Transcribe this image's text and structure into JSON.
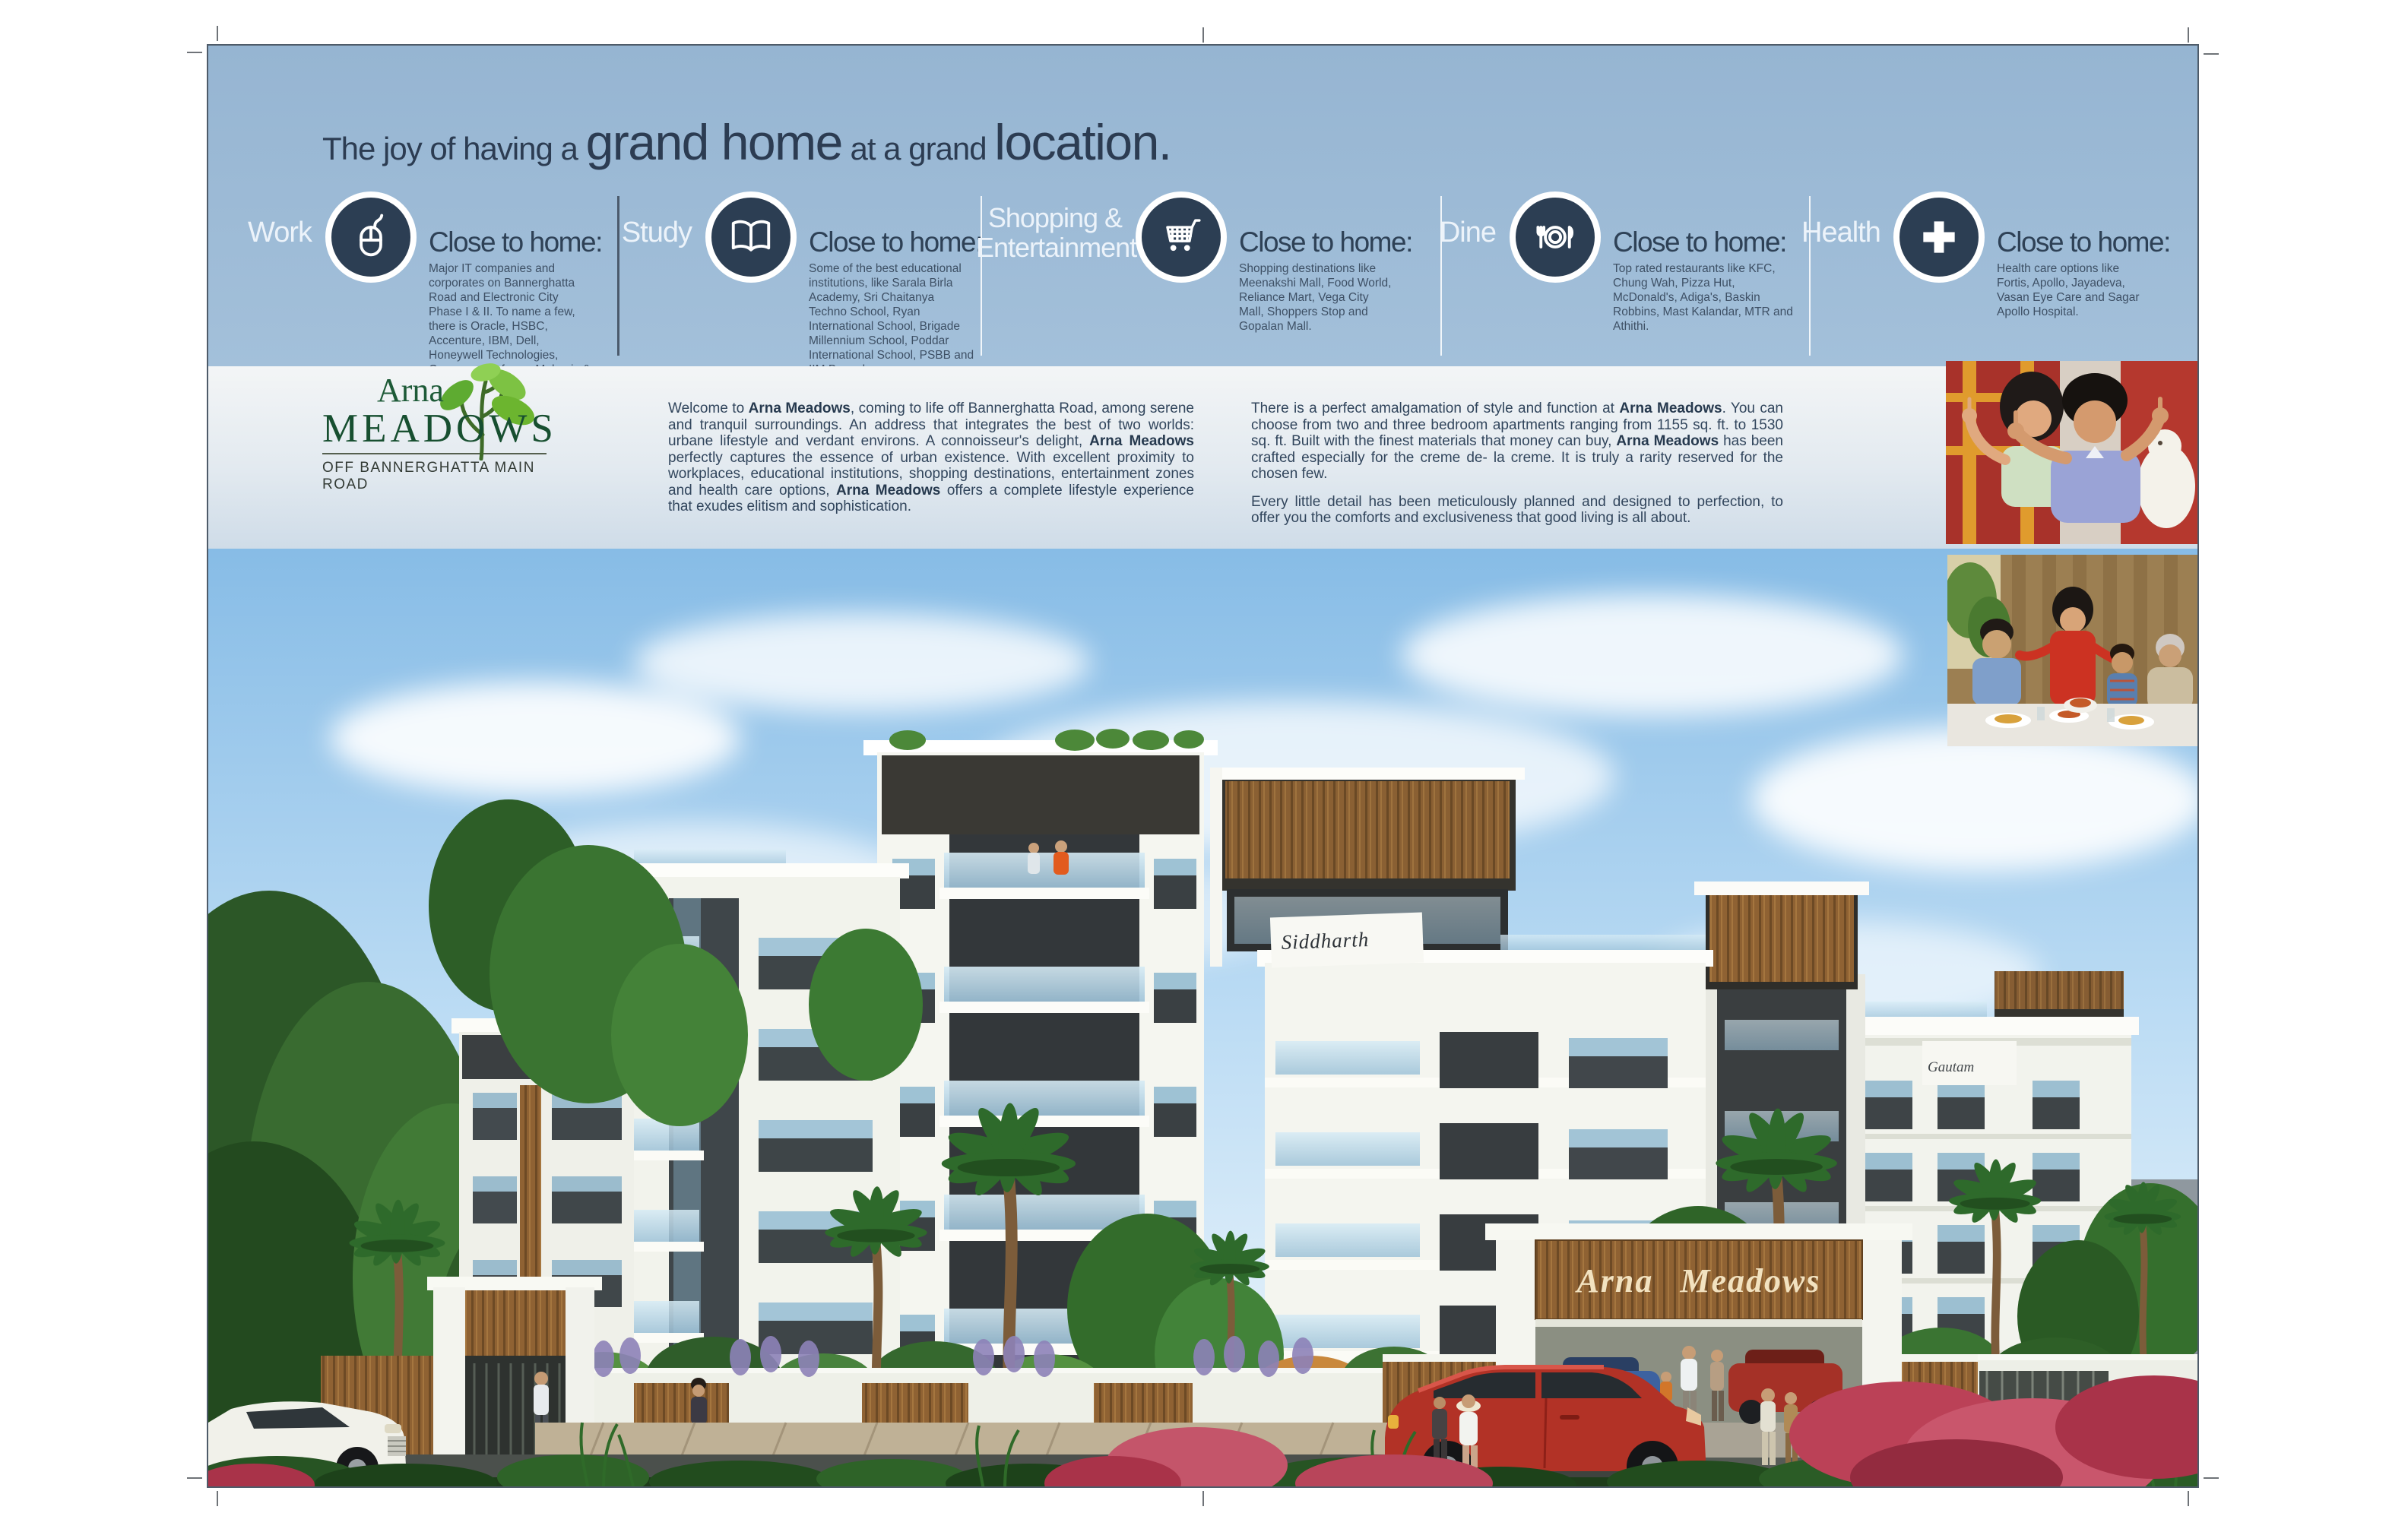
{
  "brand_colors": {
    "header_blue": "#9cbad5",
    "icon_navy": "#2c3e53",
    "headline_navy": "#2c3c52",
    "body_text": "#33465c",
    "logo_green": "#1d5a37",
    "leaf_green": "#6cb52f",
    "wood_brown": "#8f6233",
    "sky_blue": "#87bce6",
    "red_car": "#b23226"
  },
  "header": {
    "headline": {
      "part1": "The joy of having a ",
      "part2": "grand home",
      "part3": " at a grand ",
      "part4": "location."
    },
    "columns": [
      {
        "label": "Work",
        "icon": "computer-mouse-icon",
        "heading": "Close to home:",
        "body": "Major IT companies and corporates on Bannerghatta Road and Electronic City Phase I & II. To name a few, there is Oracle, HSBC, Accenture, IBM, Dell, Honeywell Technologies, Convergys, Infosys, Mphasis & Adobe Systems."
      },
      {
        "label": "Study",
        "icon": "open-book-icon",
        "heading": "Close to home:",
        "body": "Some of the best educational institutions, like Sarala Birla Academy, Sri Chaitanya Techno School, Ryan International School, Brigade Millennium School, Poddar International School, PSBB and IIM Bangalore."
      },
      {
        "label": "Shopping & Entertainment",
        "icon": "shopping-cart-icon",
        "heading": "Close to home:",
        "body": "Shopping destinations like Meenakshi Mall, Food World, Reliance Mart, Vega City Mall, Shoppers Stop and Gopalan Mall."
      },
      {
        "label": "Dine",
        "icon": "plate-cutlery-icon",
        "heading": "Close to home:",
        "body": "Top rated restaurants like KFC, Chung Wah, Pizza Hut, McDonald's, Adiga's, Baskin Robbins, Mast Kalandar, MTR and Athithi."
      },
      {
        "label": "Health",
        "icon": "medical-cross-icon",
        "heading": "Close to home:",
        "body": "Health care options like Fortis, Apollo, Jayadeva, Vasan Eye Care and Sagar Apollo Hospital."
      }
    ]
  },
  "logo": {
    "line1": "Arna",
    "line2": "MEADOWS",
    "tagline": "OFF BANNERGHATTA MAIN ROAD"
  },
  "intro": {
    "p1": [
      {
        "text": "Welcome to "
      },
      {
        "text": "Arna Meadows",
        "bold": true
      },
      {
        "text": ", coming to life off Bannerghatta Road, among serene and tranquil surroundings. An address that integrates the best of two worlds: urbane lifestyle and verdant environs. A connoisseur's delight, "
      },
      {
        "text": "Arna Meadows",
        "bold": true
      },
      {
        "text": " perfectly captures the essence of urban existence. With excellent proximity to workplaces, educational institutions, shopping destinations, entertainment zones and health care options, "
      },
      {
        "text": "Arna Meadows",
        "bold": true
      },
      {
        "text": " offers a complete lifestyle experience that exudes elitism and sophistication."
      }
    ],
    "p2": [
      {
        "text": "There is a perfect amalgamation of style and function at "
      },
      {
        "text": "Arna Meadows",
        "bold": true
      },
      {
        "text": ". You can choose from two and three bedroom apartments ranging from 1155 sq. ft. to 1530 sq. ft. Built with the finest materials that money can buy, "
      },
      {
        "text": "Arna Meadows",
        "bold": true
      },
      {
        "text": " has been crafted especially for the creme de- la creme. It is truly a rarity reserved for the chosen few."
      }
    ],
    "p3": "Every little detail has been meticulously planned and designed to perfection, to offer you the comforts and exclusiveness that good living is all about."
  },
  "render": {
    "sign_left": "Siddharth",
    "sign_right": "Gautam",
    "gate_sign": "Arna Meadows"
  },
  "photos": [
    {
      "name": "couple-photo",
      "alt": "Smiling couple framing a view with their hands"
    },
    {
      "name": "family-dining-photo",
      "alt": "Family enjoying a meal together"
    }
  ]
}
